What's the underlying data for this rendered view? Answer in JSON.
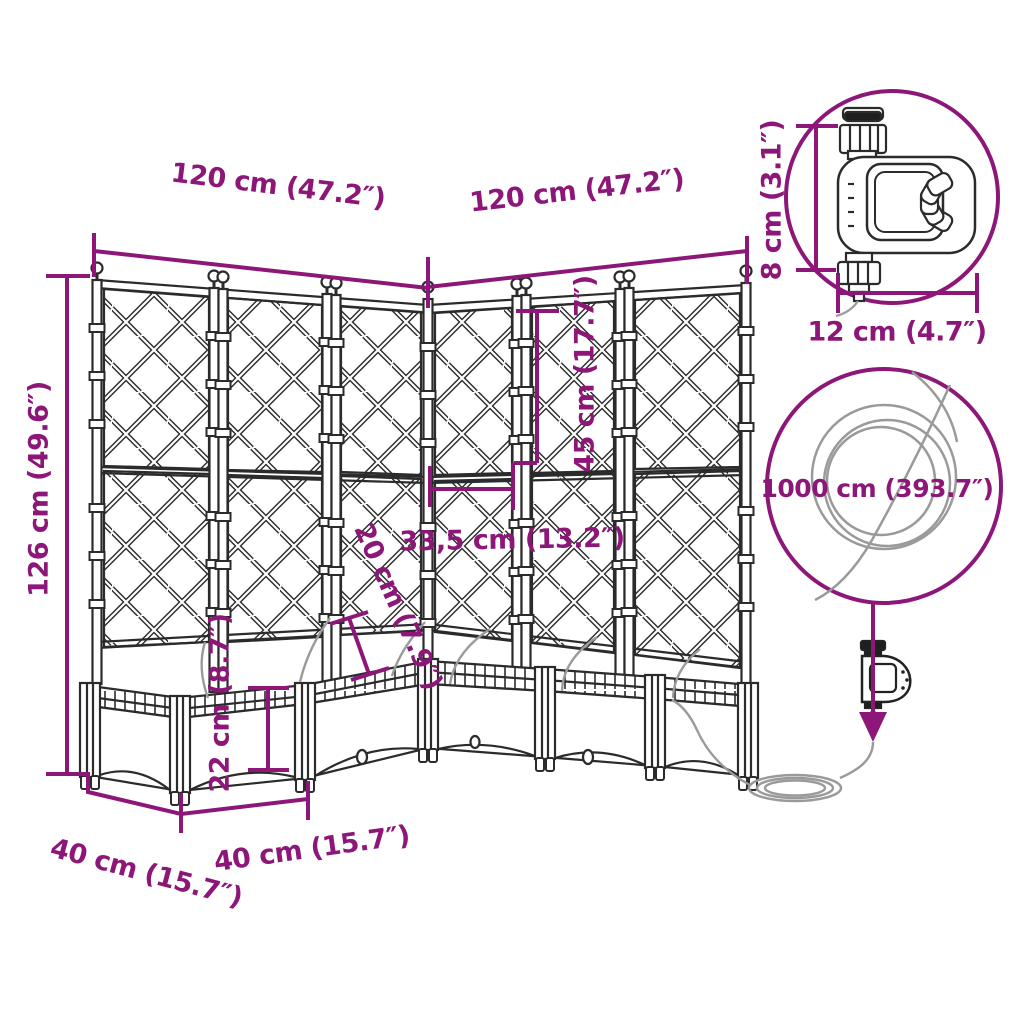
{
  "image_type": "product dimension diagram",
  "product": "corner garden planter with trellis, watering timer and hose",
  "colors": {
    "dimension_accent": "#8D1779",
    "line_art": "#2B2B2B",
    "hose_gray": "#9A9A9A",
    "background": "#FFFFFF"
  },
  "labels": {
    "left_wall_width": "120 cm (47.2″)",
    "right_wall_width": "120 cm (47.2″)",
    "overall_height": "126 cm (49.6″)",
    "upper_trellis_height": "45 cm (17.7″)",
    "corner_section_width": "33,5 cm (13.2″)",
    "planter_inner_depth": "20 cm (7.9″)",
    "planter_box_height": "22 cm (8.7″)",
    "left_box_depth": "40 cm (15.7″)",
    "right_box_depth": "40 cm (15.7″)",
    "timer_height": "8 cm (3.1″)",
    "timer_width": "12 cm (4.7″)",
    "hose_length": "1000 cm (393.7″)"
  }
}
